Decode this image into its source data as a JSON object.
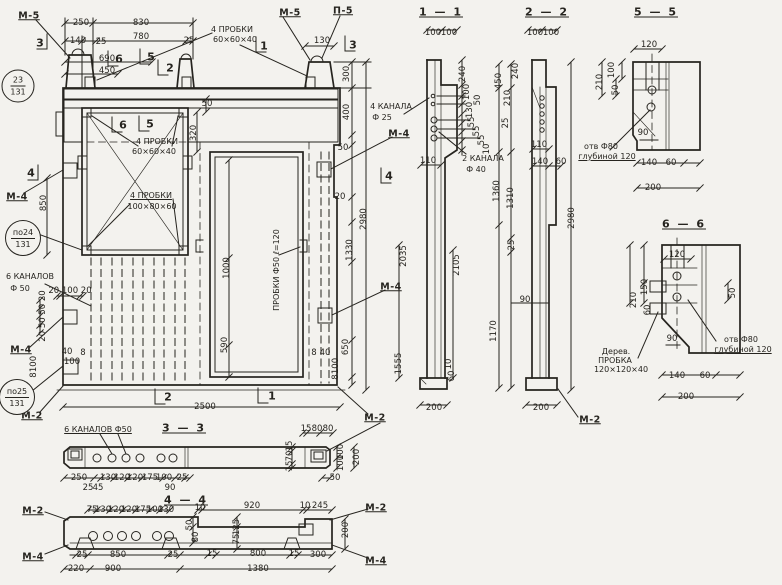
{
  "drawing": {
    "kind": "precast concrete wall panel working drawing",
    "language": "ru",
    "ink_color": "#26241f",
    "paper_color": "#f3f2ee"
  },
  "mark_circles": [
    {
      "top": "23",
      "bottom": "131",
      "x": 18,
      "y": 86,
      "d": 31
    },
    {
      "top": "по24",
      "bottom": "131",
      "x": 23,
      "y": 238,
      "d": 34
    },
    {
      "top": "по25",
      "bottom": "131",
      "x": 17,
      "y": 397,
      "d": 34
    }
  ],
  "labels": [
    {
      "t": "1 — 1",
      "x": 441,
      "y": 12,
      "c": "title",
      "u": 1,
      "n": "section-title-1-1"
    },
    {
      "t": "2 — 2",
      "x": 547,
      "y": 12,
      "c": "title",
      "u": 1,
      "n": "section-title-2-2"
    },
    {
      "t": "5 — 5",
      "x": 656,
      "y": 12,
      "c": "title",
      "u": 1,
      "n": "section-title-5-5"
    },
    {
      "t": "6 — 6",
      "x": 684,
      "y": 224,
      "c": "title",
      "u": 1,
      "n": "section-title-6-6"
    },
    {
      "t": "3 — 3",
      "x": 184,
      "y": 428,
      "c": "title",
      "u": 1,
      "n": "section-title-3-3"
    },
    {
      "t": "4 — 4",
      "x": 186,
      "y": 500,
      "c": "title",
      "u": 1,
      "n": "section-title-4-4"
    },
    {
      "t": "М-5",
      "x": 29,
      "y": 16,
      "c": "mark",
      "u": 1,
      "n": "mark-m5-left"
    },
    {
      "t": "М-5",
      "x": 290,
      "y": 13,
      "c": "mark",
      "u": 1,
      "n": "mark-m5-mid"
    },
    {
      "t": "П-5",
      "x": 343,
      "y": 11,
      "c": "mark",
      "u": 1,
      "n": "mark-p5"
    },
    {
      "t": "М-4",
      "x": 17,
      "y": 197,
      "c": "mark",
      "u": 1,
      "n": "mark-m4-left-upper"
    },
    {
      "t": "М-4",
      "x": 21,
      "y": 350,
      "c": "mark",
      "u": 1,
      "n": "mark-m4-left-lower"
    },
    {
      "t": "М-2",
      "x": 32,
      "y": 416,
      "c": "mark",
      "u": 1,
      "n": "mark-m2-left"
    },
    {
      "t": "М-4",
      "x": 399,
      "y": 134,
      "c": "mark",
      "u": 1,
      "n": "mark-m4-right-upper"
    },
    {
      "t": "М-4",
      "x": 391,
      "y": 287,
      "c": "mark",
      "u": 1,
      "n": "mark-m4-right-lower"
    },
    {
      "t": "М-2",
      "x": 375,
      "y": 418,
      "c": "mark",
      "u": 1,
      "n": "mark-m2-right"
    },
    {
      "t": "М-2",
      "x": 590,
      "y": 420,
      "c": "mark",
      "u": 1,
      "n": "mark-m2-section22"
    },
    {
      "t": "М-2",
      "x": 33,
      "y": 511,
      "c": "mark",
      "u": 1,
      "n": "mark-m2-44-left"
    },
    {
      "t": "М-2",
      "x": 376,
      "y": 508,
      "c": "mark",
      "u": 1,
      "n": "mark-m2-44-right"
    },
    {
      "t": "М-4",
      "x": 33,
      "y": 557,
      "c": "mark",
      "u": 1,
      "n": "mark-m4-44-left"
    },
    {
      "t": "М-4",
      "x": 376,
      "y": 561,
      "c": "mark",
      "u": 1,
      "n": "mark-m4-44-right"
    },
    {
      "t": "3",
      "x": 40,
      "y": 43,
      "c": "marker",
      "n": "cut-marker-3-left"
    },
    {
      "t": "3",
      "x": 353,
      "y": 45,
      "c": "marker",
      "n": "cut-marker-3-right"
    },
    {
      "t": "1",
      "x": 264,
      "y": 46,
      "c": "marker",
      "n": "cut-marker-1-top"
    },
    {
      "t": "1",
      "x": 272,
      "y": 396,
      "c": "marker",
      "n": "cut-marker-1-bottom"
    },
    {
      "t": "2",
      "x": 170,
      "y": 68,
      "c": "marker",
      "n": "cut-marker-2-top"
    },
    {
      "t": "2",
      "x": 168,
      "y": 397,
      "c": "marker",
      "n": "cut-marker-2-bottom"
    },
    {
      "t": "5",
      "x": 151,
      "y": 57,
      "c": "marker",
      "n": "cut-marker-5-top"
    },
    {
      "t": "6",
      "x": 119,
      "y": 59,
      "c": "marker",
      "n": "cut-marker-6-top"
    },
    {
      "t": "5",
      "x": 150,
      "y": 124,
      "c": "marker",
      "n": "cut-marker-5-window"
    },
    {
      "t": "6",
      "x": 123,
      "y": 125,
      "c": "marker",
      "n": "cut-marker-6-window"
    },
    {
      "t": "4",
      "x": 31,
      "y": 173,
      "c": "marker",
      "n": "cut-marker-4-left"
    },
    {
      "t": "4",
      "x": 389,
      "y": 176,
      "c": "marker",
      "n": "cut-marker-4-right"
    },
    {
      "t": "4 ПРОБКИ",
      "x": 232,
      "y": 30,
      "c": "ann",
      "n": "annotation-plugs-top"
    },
    {
      "t": "60×60×40",
      "x": 235,
      "y": 40,
      "c": "ann",
      "n": "annotation-plugs-top-size"
    },
    {
      "t": "4 ПРОБКИ",
      "x": 157,
      "y": 142,
      "c": "ann",
      "n": "annotation-plugs-window"
    },
    {
      "t": "60×60×40",
      "x": 154,
      "y": 152,
      "c": "ann",
      "n": "annotation-plugs-window-size"
    },
    {
      "t": "4 ПРОБКИ",
      "x": 151,
      "y": 196,
      "c": "ann",
      "u": 1,
      "n": "annotation-plugs-100"
    },
    {
      "t": "100×80×60",
      "x": 152,
      "y": 207,
      "c": "ann",
      "n": "annotation-plugs-100-size"
    },
    {
      "t": "ПРОБКИ Ф50 ℓ=120",
      "x": 277,
      "y": 270,
      "c": "ann",
      "r": -90,
      "n": "annotation-door-plugs"
    },
    {
      "t": "4 КАНАЛА",
      "x": 391,
      "y": 107,
      "c": "ann",
      "n": "annotation-4-channels"
    },
    {
      "t": "Ф 25",
      "x": 382,
      "y": 118,
      "c": "ann",
      "n": "annotation-4-channels-dia"
    },
    {
      "t": "2 КАНАЛА",
      "x": 483,
      "y": 159,
      "c": "ann",
      "n": "annotation-2-channels"
    },
    {
      "t": "Ф 40",
      "x": 476,
      "y": 170,
      "c": "ann",
      "n": "annotation-2-channels-dia"
    },
    {
      "t": "6 КАНАЛОВ",
      "x": 30,
      "y": 277,
      "c": "ann",
      "n": "annotation-6-channels"
    },
    {
      "t": "Ф 50",
      "x": 20,
      "y": 289,
      "c": "ann",
      "n": "annotation-6-channels-dia"
    },
    {
      "t": "6 КАНАЛОВ Ф50",
      "x": 98,
      "y": 430,
      "c": "ann",
      "u": 1,
      "n": "annotation-6-channels-33"
    },
    {
      "t": "отв Ф80",
      "x": 601,
      "y": 147,
      "c": "ann",
      "n": "annotation-hole-55"
    },
    {
      "t": "глубиной 120",
      "x": 607,
      "y": 157,
      "c": "ann",
      "u": 1,
      "n": "annotation-hole-55-depth"
    },
    {
      "t": "отв Ф80",
      "x": 741,
      "y": 340,
      "c": "ann",
      "n": "annotation-hole-66"
    },
    {
      "t": "глубиной 120",
      "x": 743,
      "y": 350,
      "c": "ann",
      "u": 1,
      "n": "annotation-hole-66-depth"
    },
    {
      "t": "Дерев.",
      "x": 616,
      "y": 352,
      "c": "ann",
      "n": "annotation-wood-plug-1"
    },
    {
      "t": "ПРОБКА",
      "x": 615,
      "y": 361,
      "c": "ann",
      "n": "annotation-wood-plug-2"
    },
    {
      "t": "120×120×40",
      "x": 621,
      "y": 370,
      "c": "ann",
      "n": "annotation-wood-plug-3"
    },
    {
      "t": "250",
      "x": 81,
      "y": 23,
      "n": "dim"
    },
    {
      "t": "830",
      "x": 141,
      "y": 23,
      "n": "dim"
    },
    {
      "t": "140",
      "x": 78,
      "y": 41,
      "n": "dim"
    },
    {
      "t": "25",
      "x": 101,
      "y": 42,
      "n": "dim"
    },
    {
      "t": "780",
      "x": 141,
      "y": 37,
      "n": "dim"
    },
    {
      "t": "25",
      "x": 189,
      "y": 41,
      "n": "dim"
    },
    {
      "t": "690",
      "x": 107,
      "y": 59,
      "n": "dim"
    },
    {
      "t": "450",
      "x": 107,
      "y": 71,
      "n": "dim"
    },
    {
      "t": "130",
      "x": 322,
      "y": 41,
      "n": "dim"
    },
    {
      "t": "300",
      "x": 347,
      "y": 74,
      "r": -90,
      "n": "dim"
    },
    {
      "t": "400",
      "x": 347,
      "y": 112,
      "r": -90,
      "n": "dim"
    },
    {
      "t": "50",
      "x": 343,
      "y": 148,
      "n": "dim"
    },
    {
      "t": "20",
      "x": 340,
      "y": 197,
      "n": "dim"
    },
    {
      "t": "2980",
      "x": 364,
      "y": 219,
      "r": -90,
      "n": "dim"
    },
    {
      "t": "1330",
      "x": 350,
      "y": 250,
      "r": -90,
      "n": "dim"
    },
    {
      "t": "650",
      "x": 346,
      "y": 347,
      "r": -90,
      "n": "dim"
    },
    {
      "t": "8",
      "x": 314,
      "y": 353,
      "n": "dim"
    },
    {
      "t": "40",
      "x": 325,
      "y": 353,
      "n": "dim"
    },
    {
      "t": "100",
      "x": 336,
      "y": 366,
      "r": -90,
      "n": "dim"
    },
    {
      "t": "8",
      "x": 336,
      "y": 377,
      "r": -90,
      "n": "dim"
    },
    {
      "t": "850",
      "x": 44,
      "y": 203,
      "r": -90,
      "n": "dim"
    },
    {
      "t": "20 100 20",
      "x": 70,
      "y": 291,
      "n": "dim"
    },
    {
      "t": "20 50 50 20",
      "x": 43,
      "y": 316,
      "r": -90,
      "n": "dim"
    },
    {
      "t": "40",
      "x": 67,
      "y": 352,
      "n": "dim"
    },
    {
      "t": "8",
      "x": 83,
      "y": 353,
      "n": "dim"
    },
    {
      "t": "100",
      "x": 72,
      "y": 362,
      "n": "dim"
    },
    {
      "t": "100",
      "x": 34,
      "y": 364,
      "r": -90,
      "n": "dim"
    },
    {
      "t": "8",
      "x": 34,
      "y": 375,
      "r": -90,
      "n": "dim"
    },
    {
      "t": "2500",
      "x": 205,
      "y": 407,
      "n": "dim"
    },
    {
      "t": "1000",
      "x": 227,
      "y": 268,
      "r": -90,
      "n": "dim"
    },
    {
      "t": "590",
      "x": 225,
      "y": 345,
      "r": -90,
      "n": "dim"
    },
    {
      "t": "320",
      "x": 194,
      "y": 133,
      "r": -90,
      "n": "dim"
    },
    {
      "t": "50",
      "x": 207,
      "y": 104,
      "n": "dim"
    },
    {
      "t": "100",
      "x": 433,
      "y": 33,
      "n": "dim"
    },
    {
      "t": "100",
      "x": 449,
      "y": 33,
      "n": "dim"
    },
    {
      "t": "240",
      "x": 463,
      "y": 74,
      "r": -90,
      "n": "dim"
    },
    {
      "t": "100",
      "x": 467,
      "y": 92,
      "r": -90,
      "n": "dim"
    },
    {
      "t": "50",
      "x": 478,
      "y": 100,
      "r": -90,
      "n": "dim"
    },
    {
      "t": "130",
      "x": 470,
      "y": 110,
      "r": -90,
      "n": "dim"
    },
    {
      "t": "55",
      "x": 472,
      "y": 122,
      "r": -90,
      "n": "dim"
    },
    {
      "t": "55",
      "x": 477,
      "y": 131,
      "r": -90,
      "n": "dim"
    },
    {
      "t": "55",
      "x": 482,
      "y": 140,
      "r": -90,
      "n": "dim"
    },
    {
      "t": "10",
      "x": 487,
      "y": 149,
      "r": -90,
      "n": "dim"
    },
    {
      "t": "110",
      "x": 428,
      "y": 161,
      "n": "dim"
    },
    {
      "t": "2035",
      "x": 404,
      "y": 256,
      "r": -90,
      "n": "dim"
    },
    {
      "t": "2105",
      "x": 457,
      "y": 265,
      "r": -90,
      "n": "dim"
    },
    {
      "t": "55",
      "x": 399,
      "y": 358,
      "r": -90,
      "n": "dim"
    },
    {
      "t": "15",
      "x": 399,
      "y": 369,
      "r": -90,
      "n": "dim"
    },
    {
      "t": "10",
      "x": 449,
      "y": 364,
      "r": -90,
      "n": "dim"
    },
    {
      "t": "60",
      "x": 452,
      "y": 376,
      "r": -90,
      "n": "dim"
    },
    {
      "t": "200",
      "x": 434,
      "y": 408,
      "n": "dim"
    },
    {
      "t": "450",
      "x": 499,
      "y": 81,
      "r": -90,
      "n": "dim"
    },
    {
      "t": "210",
      "x": 508,
      "y": 98,
      "r": -90,
      "n": "dim"
    },
    {
      "t": "25",
      "x": 506,
      "y": 123,
      "r": -90,
      "n": "dim"
    },
    {
      "t": "1360",
      "x": 497,
      "y": 191,
      "r": -90,
      "n": "dim"
    },
    {
      "t": "240",
      "x": 516,
      "y": 71,
      "r": -90,
      "n": "dim"
    },
    {
      "t": "1310",
      "x": 511,
      "y": 198,
      "r": -90,
      "n": "dim"
    },
    {
      "t": "100",
      "x": 535,
      "y": 33,
      "n": "dim"
    },
    {
      "t": "100",
      "x": 551,
      "y": 33,
      "n": "dim"
    },
    {
      "t": "110",
      "x": 539,
      "y": 145,
      "n": "dim"
    },
    {
      "t": "140",
      "x": 540,
      "y": 162,
      "n": "dim"
    },
    {
      "t": "60",
      "x": 561,
      "y": 162,
      "n": "dim"
    },
    {
      "t": "2980",
      "x": 572,
      "y": 218,
      "r": -90,
      "n": "dim"
    },
    {
      "t": "25",
      "x": 512,
      "y": 245,
      "r": -90,
      "n": "dim"
    },
    {
      "t": "90",
      "x": 525,
      "y": 300,
      "n": "dim"
    },
    {
      "t": "1170",
      "x": 494,
      "y": 331,
      "r": -90,
      "n": "dim"
    },
    {
      "t": "200",
      "x": 541,
      "y": 408,
      "n": "dim"
    },
    {
      "t": "120",
      "x": 649,
      "y": 45,
      "n": "dim"
    },
    {
      "t": "100",
      "x": 612,
      "y": 70,
      "r": -90,
      "n": "dim"
    },
    {
      "t": "210",
      "x": 600,
      "y": 82,
      "r": -90,
      "n": "dim"
    },
    {
      "t": "50",
      "x": 616,
      "y": 90,
      "r": -90,
      "n": "dim"
    },
    {
      "t": "90",
      "x": 643,
      "y": 133,
      "n": "dim"
    },
    {
      "t": "140",
      "x": 649,
      "y": 163,
      "n": "dim"
    },
    {
      "t": "60",
      "x": 671,
      "y": 163,
      "n": "dim"
    },
    {
      "t": "200",
      "x": 653,
      "y": 188,
      "n": "dim"
    },
    {
      "t": "120",
      "x": 677,
      "y": 255,
      "n": "dim"
    },
    {
      "t": "150",
      "x": 645,
      "y": 287,
      "r": -90,
      "n": "dim"
    },
    {
      "t": "210",
      "x": 634,
      "y": 300,
      "r": -90,
      "n": "dim"
    },
    {
      "t": "60",
      "x": 648,
      "y": 310,
      "r": -90,
      "n": "dim"
    },
    {
      "t": "50",
      "x": 733,
      "y": 293,
      "r": -90,
      "n": "dim"
    },
    {
      "t": "90",
      "x": 672,
      "y": 339,
      "n": "dim"
    },
    {
      "t": "140",
      "x": 677,
      "y": 376,
      "n": "dim"
    },
    {
      "t": "60",
      "x": 705,
      "y": 376,
      "n": "dim"
    },
    {
      "t": "200",
      "x": 686,
      "y": 397,
      "n": "dim"
    },
    {
      "t": "15",
      "x": 306,
      "y": 429,
      "n": "dim"
    },
    {
      "t": "80",
      "x": 317,
      "y": 429,
      "n": "dim"
    },
    {
      "t": "80",
      "x": 328,
      "y": 429,
      "n": "dim"
    },
    {
      "t": "15",
      "x": 290,
      "y": 446,
      "r": -90,
      "n": "dim"
    },
    {
      "t": "70",
      "x": 290,
      "y": 456,
      "r": -90,
      "n": "dim"
    },
    {
      "t": "15",
      "x": 290,
      "y": 466,
      "r": -90,
      "n": "dim"
    },
    {
      "t": "100",
      "x": 341,
      "y": 452,
      "r": -90,
      "n": "dim"
    },
    {
      "t": "100",
      "x": 341,
      "y": 463,
      "r": -90,
      "n": "dim"
    },
    {
      "t": "200",
      "x": 357,
      "y": 457,
      "r": -90,
      "n": "dim"
    },
    {
      "t": "250",
      "x": 79,
      "y": 478,
      "n": "dim"
    },
    {
      "t": "25",
      "x": 88,
      "y": 488,
      "n": "dim"
    },
    {
      "t": "45",
      "x": 98,
      "y": 488,
      "n": "dim"
    },
    {
      "t": "130",
      "x": 108,
      "y": 478,
      "n": "dim"
    },
    {
      "t": "120",
      "x": 122,
      "y": 478,
      "n": "dim"
    },
    {
      "t": "120",
      "x": 135,
      "y": 478,
      "n": "dim"
    },
    {
      "t": "175",
      "x": 150,
      "y": 478,
      "n": "dim"
    },
    {
      "t": "100",
      "x": 164,
      "y": 478,
      "n": "dim"
    },
    {
      "t": "90",
      "x": 170,
      "y": 488,
      "n": "dim"
    },
    {
      "t": "25",
      "x": 182,
      "y": 478,
      "n": "dim"
    },
    {
      "t": "50",
      "x": 335,
      "y": 478,
      "n": "dim"
    },
    {
      "t": "75",
      "x": 92,
      "y": 510,
      "n": "dim"
    },
    {
      "t": "130",
      "x": 103,
      "y": 510,
      "n": "dim"
    },
    {
      "t": "120",
      "x": 116,
      "y": 510,
      "n": "dim"
    },
    {
      "t": "120",
      "x": 129,
      "y": 510,
      "n": "dim"
    },
    {
      "t": "175",
      "x": 143,
      "y": 510,
      "n": "dim"
    },
    {
      "t": "100",
      "x": 155,
      "y": 510,
      "n": "dim"
    },
    {
      "t": "130",
      "x": 166,
      "y": 510,
      "n": "dim"
    },
    {
      "t": "10",
      "x": 200,
      "y": 508,
      "n": "dim"
    },
    {
      "t": "920",
      "x": 252,
      "y": 506,
      "n": "dim"
    },
    {
      "t": "10",
      "x": 305,
      "y": 506,
      "n": "dim"
    },
    {
      "t": "245",
      "x": 320,
      "y": 506,
      "n": "dim"
    },
    {
      "t": "50",
      "x": 190,
      "y": 525,
      "r": -90,
      "n": "dim"
    },
    {
      "t": "80",
      "x": 196,
      "y": 537,
      "r": -90,
      "n": "dim"
    },
    {
      "t": "125",
      "x": 237,
      "y": 527,
      "r": -90,
      "n": "dim"
    },
    {
      "t": "75",
      "x": 237,
      "y": 539,
      "r": -90,
      "n": "dim"
    },
    {
      "t": "200",
      "x": 346,
      "y": 530,
      "r": -90,
      "n": "dim"
    },
    {
      "t": "25",
      "x": 82,
      "y": 555,
      "n": "dim"
    },
    {
      "t": "850",
      "x": 118,
      "y": 555,
      "n": "dim"
    },
    {
      "t": "25",
      "x": 173,
      "y": 555,
      "n": "dim"
    },
    {
      "t": "15",
      "x": 212,
      "y": 554,
      "n": "dim"
    },
    {
      "t": "800",
      "x": 258,
      "y": 554,
      "n": "dim"
    },
    {
      "t": "15",
      "x": 294,
      "y": 554,
      "n": "dim"
    },
    {
      "t": "300",
      "x": 318,
      "y": 555,
      "n": "dim"
    },
    {
      "t": "220",
      "x": 76,
      "y": 569,
      "n": "dim"
    },
    {
      "t": "900",
      "x": 113,
      "y": 569,
      "n": "dim"
    },
    {
      "t": "1380",
      "x": 258,
      "y": 569,
      "n": "dim"
    }
  ]
}
